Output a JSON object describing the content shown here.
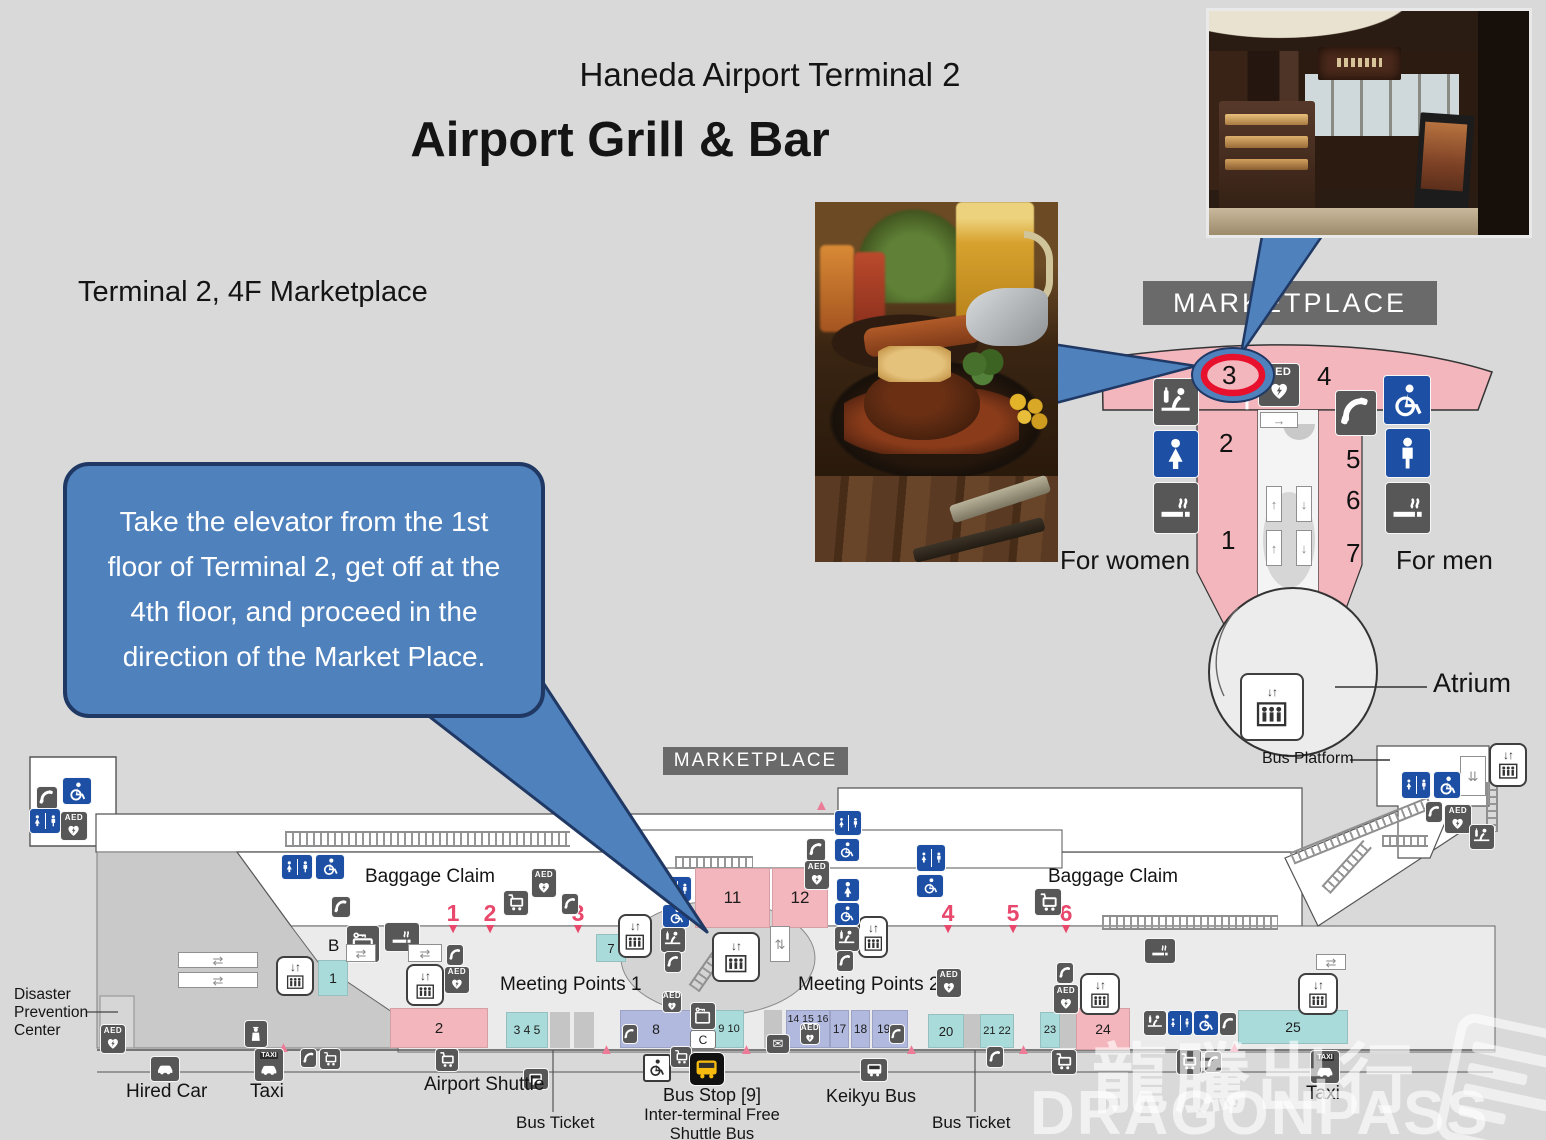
{
  "header": {
    "line1": "Haneda Airport Terminal 2",
    "line2": "Airport Grill & Bar",
    "location": "Terminal 2, 4F Marketplace"
  },
  "callout": {
    "text": "Take the elevator from the 1st floor of Terminal 2, get off at the 4th floor, and proceed in the direction of the Market Place."
  },
  "floor4": {
    "banner": "MARKETPLACE",
    "zones": {
      "z1": "1",
      "z2": "2",
      "z3": "3",
      "z4": "4",
      "z5": "5",
      "z6": "6",
      "z7": "7"
    },
    "for_women": "For women",
    "for_men": "For men",
    "atrium": "Atrium",
    "bus_platform": "Bus Platform"
  },
  "floor1": {
    "banner": "MARKETPLACE",
    "baggage_claim_left": "Baggage Claim",
    "baggage_claim_right": "Baggage Claim",
    "meeting_points_1": "Meeting Points 1",
    "meeting_points_2": "Meeting Points 2",
    "disaster_line1": "Disaster",
    "disaster_line2": "Prevention",
    "disaster_line3": "Center",
    "area_b": "B",
    "area_c": "C",
    "gates": {
      "g1": "1",
      "g2": "2",
      "g3": "3",
      "g4": "4",
      "g5": "5",
      "g6": "6"
    },
    "zones": {
      "z1": "1",
      "z2": "2",
      "z345": "3 4 5",
      "z7": "7",
      "z8": "8",
      "z910": "9 10",
      "z11": "11",
      "z12": "12",
      "z141516": "14 15 16",
      "z17": "17",
      "z18": "18",
      "z19": "19",
      "z20": "20",
      "z2122": "21 22",
      "z23": "23",
      "z24": "24",
      "z25": "25"
    },
    "hired_car": "Hired Car",
    "taxi_left": "Taxi",
    "airport_shuttle": "Airport Shuttle",
    "bus_ticket_left": "Bus Ticket",
    "bus_stop_l1": "Bus Stop [9]",
    "bus_stop_l2": "Inter-terminal Free",
    "bus_stop_l3": "Shuttle Bus",
    "keikyu_bus": "Keikyu Bus",
    "bus_ticket_right": "Bus Ticket",
    "taxi_right": "Taxi"
  },
  "icons": {
    "aed": "AED",
    "taxi": "TAXI"
  },
  "watermark": {
    "cn": "龍騰出行",
    "en": "DRAGONPASS"
  },
  "colors": {
    "background": "#d9d9d9",
    "callout_blue": "#4f81bd",
    "callout_border": "#1f3864",
    "map_pink": "#f3b6bd",
    "map_teal": "#a9dbda",
    "map_lavender": "#b2b9de",
    "icon_gray": "#575757",
    "icon_blue": "#1d50a5",
    "banner_gray": "#6a6a6a",
    "gate_red": "#e8486b",
    "circle_red": "#e8112d"
  }
}
